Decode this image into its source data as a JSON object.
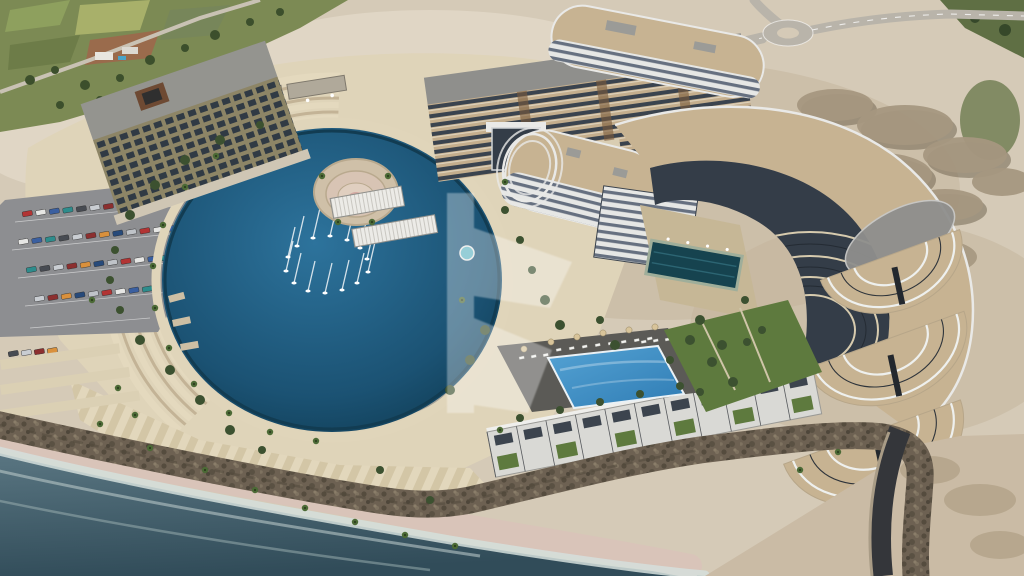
{
  "colors": {
    "sand_base": "#d5cab7",
    "sand_light": "#e3dac9",
    "sand_dark": "#c3b49c",
    "field_green": "#7c8a54",
    "road": "#b9b4aa",
    "asphalt": "#8d8e91",
    "lagoon_light": "#2d739c",
    "lagoon_deep": "#1b5273",
    "lagoon_edge": "#113f58",
    "sea_light": "#5a7682",
    "sea_deep": "#314c59",
    "foam": "#d5dfdc",
    "beach": "#d9c4b9",
    "rock": "#6d6152",
    "platform": "#dfd4b9",
    "promenade": "#e0d5ba",
    "roof_tan": "#c7b392",
    "building_white": "#e9e9e7",
    "glass_dark": "#343d48",
    "olive": "#8d8566",
    "roof_gray": "#8f8f8d",
    "pool_light": "#55a3d4",
    "pool_deep": "#2f7cb4",
    "lawn": "#5e7a3e",
    "tree": "#3c5130",
    "palm": "#4c6a36",
    "lounger": "#f2f2ef",
    "umbrella": "#d8c49a",
    "watermark": "#ffffff"
  },
  "scene": {
    "watermark": {
      "opacity": 0.33
    },
    "boats": [
      [
        297,
        246
      ],
      [
        313,
        238
      ],
      [
        330,
        236
      ],
      [
        347,
        240
      ],
      [
        360,
        248
      ],
      [
        367,
        259
      ],
      [
        368,
        272
      ],
      [
        357,
        283
      ],
      [
        342,
        290
      ],
      [
        325,
        293
      ],
      [
        308,
        291
      ],
      [
        294,
        283
      ],
      [
        286,
        271
      ],
      [
        288,
        257
      ]
    ],
    "palms": [
      [
        316,
        441
      ],
      [
        270,
        432
      ],
      [
        229,
        413
      ],
      [
        194,
        384
      ],
      [
        169,
        348
      ],
      [
        155,
        308
      ],
      [
        153,
        266
      ],
      [
        163,
        225
      ],
      [
        185,
        187
      ],
      [
        216,
        156
      ],
      [
        322,
        176
      ],
      [
        388,
        176
      ],
      [
        338,
        222
      ],
      [
        372,
        222
      ],
      [
        100,
        424
      ],
      [
        150,
        448
      ],
      [
        205,
        470
      ],
      [
        255,
        490
      ],
      [
        305,
        508
      ],
      [
        355,
        522
      ],
      [
        405,
        535
      ],
      [
        455,
        546
      ],
      [
        500,
        430
      ],
      [
        462,
        300
      ],
      [
        505,
        182
      ],
      [
        800,
        470
      ],
      [
        838,
        452
      ],
      [
        118,
        388
      ],
      [
        135,
        415
      ],
      [
        92,
        300
      ]
    ],
    "trees": [
      [
        505,
        210,
        4
      ],
      [
        520,
        240,
        4
      ],
      [
        532,
        270,
        4
      ],
      [
        545,
        300,
        5
      ],
      [
        560,
        325,
        5
      ],
      [
        600,
        320,
        4
      ],
      [
        615,
        345,
        5
      ],
      [
        485,
        330,
        5
      ],
      [
        470,
        360,
        5
      ],
      [
        450,
        390,
        5
      ],
      [
        700,
        320,
        5
      ],
      [
        722,
        345,
        5
      ],
      [
        745,
        300,
        4
      ],
      [
        762,
        330,
        4
      ],
      [
        690,
        340,
        5
      ],
      [
        712,
        362,
        5
      ],
      [
        733,
        382,
        5
      ],
      [
        700,
        392,
        4
      ],
      [
        670,
        360,
        4
      ],
      [
        747,
        342,
        4
      ],
      [
        200,
        400,
        5
      ],
      [
        170,
        370,
        5
      ],
      [
        230,
        430,
        5
      ],
      [
        262,
        450,
        4
      ],
      [
        140,
        340,
        5
      ],
      [
        120,
        310,
        4
      ],
      [
        110,
        280,
        4
      ],
      [
        115,
        250,
        4
      ],
      [
        130,
        215,
        5
      ],
      [
        155,
        185,
        5
      ],
      [
        185,
        160,
        5
      ],
      [
        220,
        140,
        5
      ],
      [
        260,
        125,
        4
      ],
      [
        520,
        418,
        4
      ],
      [
        560,
        410,
        4
      ],
      [
        600,
        402,
        4
      ],
      [
        640,
        394,
        4
      ],
      [
        680,
        386,
        4
      ],
      [
        430,
        500,
        4
      ],
      [
        380,
        470,
        4
      ]
    ],
    "cars": {
      "palette": [
        "#b23434",
        "#e6e6e4",
        "#3a5fa0",
        "#2e8c8c",
        "#474b52",
        "#c9cdd2",
        "#8c2f2f",
        "#d9903c",
        "#274a7a",
        "#bfc3c8"
      ],
      "rows": [
        {
          "x": 22,
          "y": 212,
          "n": 11,
          "dx": 13.5,
          "dy": -1.2
        },
        {
          "x": 18,
          "y": 240,
          "n": 12,
          "dx": 13.5,
          "dy": -1.2
        },
        {
          "x": 26,
          "y": 268,
          "n": 12,
          "dx": 13.5,
          "dy": -1.2
        },
        {
          "x": 34,
          "y": 297,
          "n": 9,
          "dx": 13.5,
          "dy": -1.2
        },
        {
          "x": 8,
          "y": 352,
          "n": 4,
          "dx": 13,
          "dy": -1.0
        }
      ]
    },
    "loungers": [
      {
        "x": 556,
        "y": 349,
        "n": 8,
        "dx": 13,
        "dy": -1.6
      },
      {
        "x": 641,
        "y": 341,
        "n": 5,
        "dx": 12,
        "dy": -1.2
      },
      {
        "x": 519,
        "y": 357,
        "n": 3,
        "dx": 12,
        "dy": -1.4
      }
    ],
    "umbrellas": [
      [
        551,
        342
      ],
      [
        577,
        337
      ],
      [
        603,
        333
      ],
      [
        629,
        330
      ],
      [
        655,
        327
      ],
      [
        524,
        349
      ]
    ],
    "townhouses": {
      "units": 11,
      "unit_width": 30
    }
  }
}
